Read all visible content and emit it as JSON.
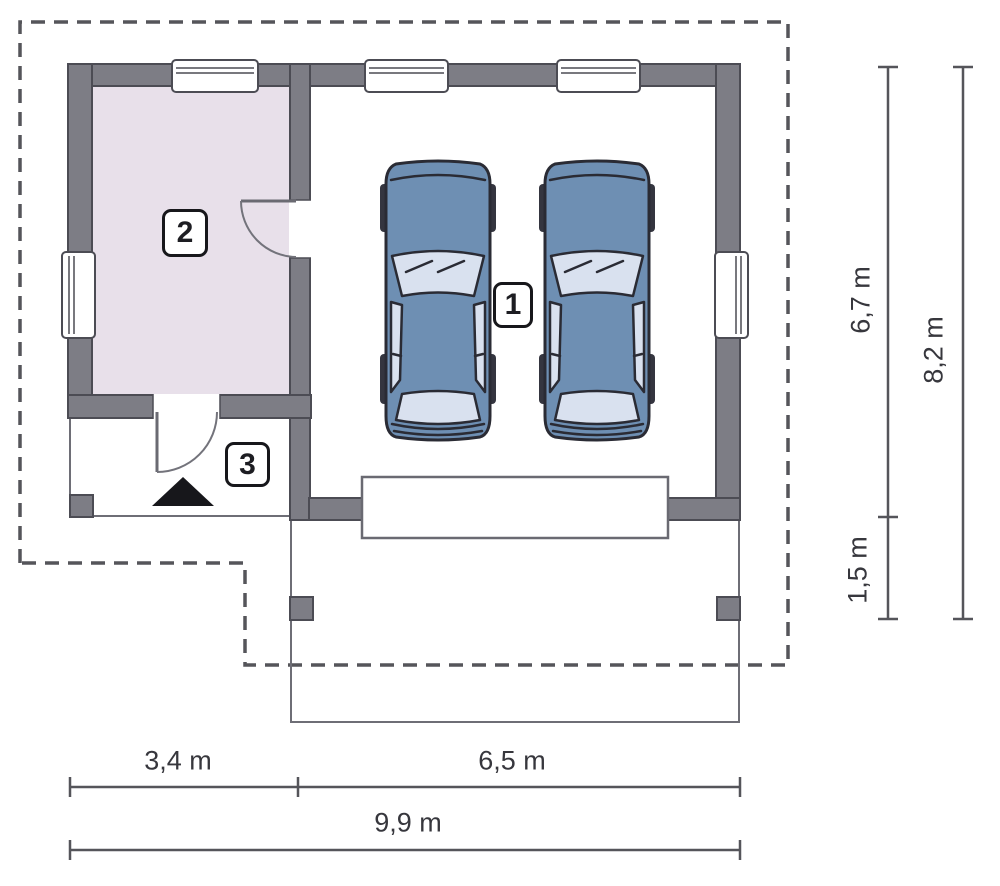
{
  "title": "Garage floor plan with two cars",
  "rooms": [
    {
      "key": "garage",
      "label": "1"
    },
    {
      "key": "utility-room",
      "label": "2"
    },
    {
      "key": "entry-porch",
      "label": "3"
    }
  ],
  "dimensions": {
    "right_depth": "6,7 m",
    "right_driveway": "1,5 m",
    "right_total": "8,2 m",
    "bottom_left": "3,4 m",
    "bottom_right": "6,5 m",
    "bottom_total": "9,9 m"
  },
  "colors": {
    "wall": "#7d7d85",
    "wall_line": "#4c4c54",
    "room_fill": "#e8e0ea",
    "line": "#6e6e76",
    "dash": "#55555a",
    "dim": "#55555a",
    "text": "#37373d",
    "car_body": "#6e8fb3",
    "car_glass": "#d9e1ef",
    "car_line": "#2a2b34",
    "tire": "#34353f",
    "black": "#17171b"
  }
}
